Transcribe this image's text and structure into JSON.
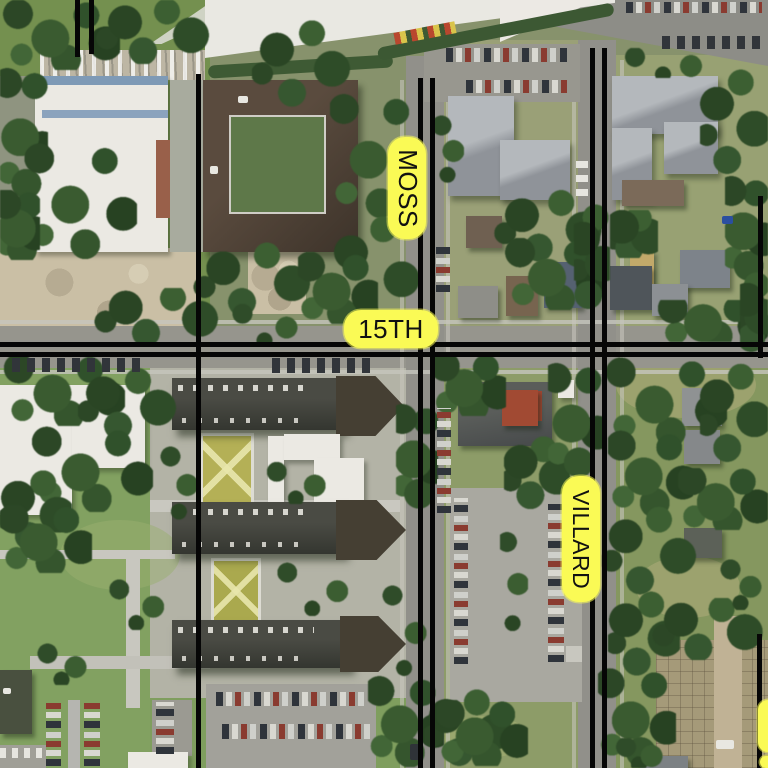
{
  "map": {
    "description": "Aerial imagery with black street centerline overlay and yellow street name labels",
    "street_labels": [
      {
        "id": "moss",
        "text": "MOSS",
        "orientation": "vertical"
      },
      {
        "id": "fifteenth",
        "text": "15TH",
        "orientation": "horizontal"
      },
      {
        "id": "villard",
        "text": "VILLARD",
        "orientation": "vertical"
      },
      {
        "id": "edge-partial",
        "text": "",
        "orientation": "vertical"
      }
    ],
    "colors": {
      "label_background": "#FAFA55",
      "label_text": "#111111",
      "street_line": "#060606"
    }
  }
}
